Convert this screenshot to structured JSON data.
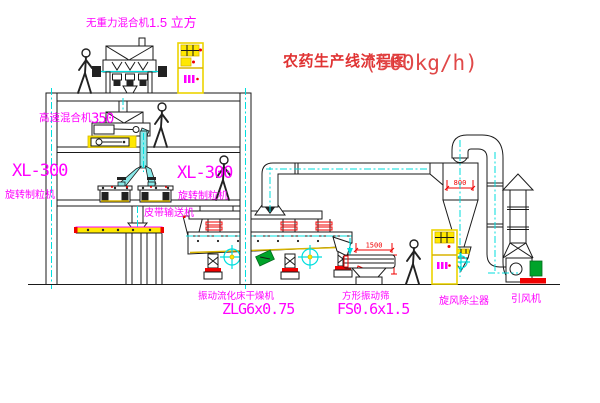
{
  "title": {
    "name": "农药生产线流程图",
    "capacity": "(500kg/h)"
  },
  "labels": {
    "top_mixer_name": "无重力混合机",
    "top_mixer_size": "1.5 立方",
    "mid_mixer_name": "高速混合机",
    "mid_mixer_size": "350",
    "granulator_left_model": "XL-300",
    "granulator_left_name": "旋转制粒机",
    "granulator_right_model": "XL-300",
    "granulator_right_name": "旋转制粒机",
    "belt_conveyor": "皮带输送机",
    "dryer_name": "振动流化床干燥机",
    "dryer_model": "ZLG6x0.75",
    "sieve_name": "方形振动筛",
    "sieve_model": "FS0.6x1.5",
    "cyclone_name": "旋风除尘器",
    "fan_name": "引风机"
  },
  "dimensions": {
    "cyclone_inlet_width": "800",
    "sieve_length": "1500"
  },
  "colors": {
    "label_magenta": "#ff00ff",
    "dimension_red": "#f00000",
    "title_red": "#e03333",
    "centerline_cyan": "#00dede",
    "highlight_yellow": "#ffe800",
    "motor_green": "#00a32a",
    "line_black": "#1a1a1a",
    "background": "#ffffff"
  }
}
